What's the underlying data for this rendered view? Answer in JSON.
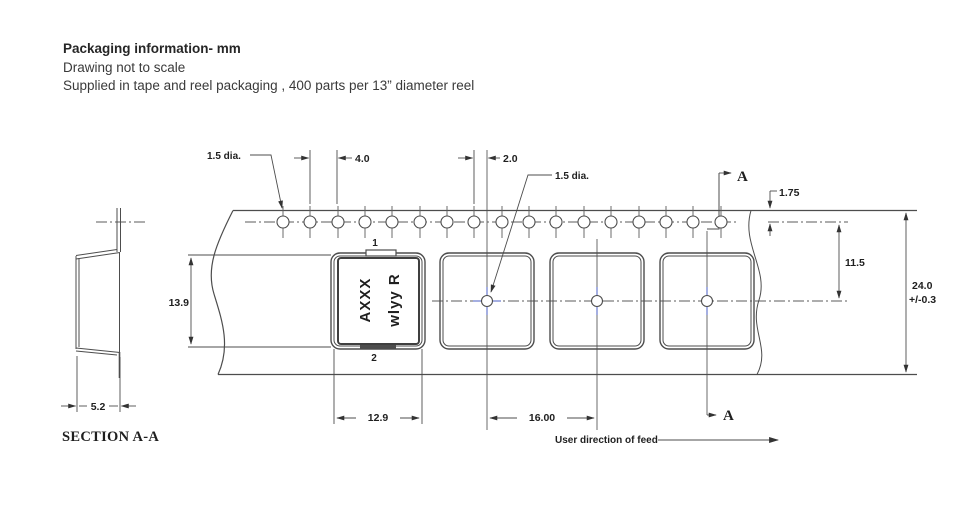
{
  "header": {
    "title": "Packaging information- mm",
    "subtitle1": "Drawing not to scale",
    "subtitle2": "Supplied in tape and reel packaging , 400 parts per 13” diameter reel"
  },
  "drawing": {
    "dims": {
      "hole_dia": "1.5 dia.",
      "hole_pitch": "4.0",
      "hole_to_pocket": "2.0",
      "center_hole_dia": "1.5 dia.",
      "edge_to_hole": "1.75",
      "hole_to_center": "11.5",
      "tape_width": "24.0",
      "tape_width_tol": "+/-0.3",
      "pocket_height": "13.9",
      "pocket_width": "12.9",
      "pocket_pitch": "16.00",
      "pocket_depth": "5.2"
    },
    "section_label": "SECTION A-A",
    "section_marker": "A",
    "pin1": "1",
    "pin2": "2",
    "feed_label": "User direction of feed",
    "part_marking": {
      "line1": "AXXX",
      "line2": "wlyy R",
      "line1_color": "#94470f",
      "line2_color": "#2e4796"
    }
  }
}
